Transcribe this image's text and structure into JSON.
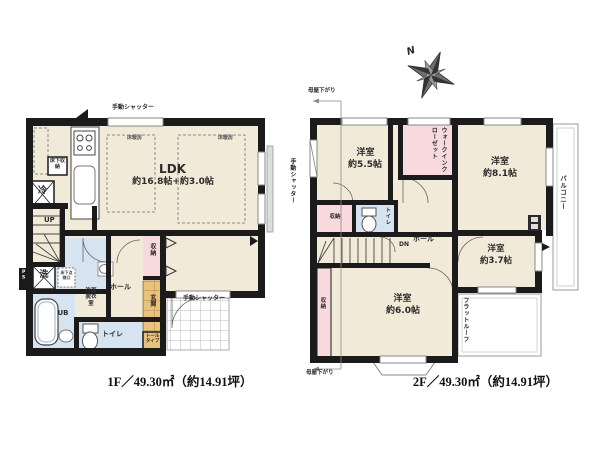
{
  "palette": {
    "wall": "#1b1b1b",
    "room_cream": "#f1ead8",
    "closet_pink": "#f8d9de",
    "wet_blue": "#d6e4f1",
    "tile_orange": "#e9c27e",
    "outline_gray": "#999999"
  },
  "compass": {
    "north_label": "N"
  },
  "floor1": {
    "caption": "1F／49.30㎡（約14.91坪）",
    "rooms": {
      "ldk_name": "LDK",
      "ldk_size": "約16.8帖+約3.0帖",
      "washroom": "洗面脱衣室",
      "bath": "UB",
      "toilet": "トイレ",
      "hall": "ホール",
      "closet": "収納",
      "entrance": "玄関"
    },
    "labels": {
      "shutter_top": "手動シャッター",
      "shutter_right": "手動シャッター",
      "shutter_bottom": "手動シャッター",
      "floor_heating": "床暖房",
      "underfloor_storage": "床下収納",
      "underfloor_hatch": "床下点検口",
      "fridge": "冷",
      "washer": "洗",
      "stairs_up": "UP",
      "tall_cabinet": "トールタイプ",
      "pipe_space": "PS"
    }
  },
  "floor2": {
    "caption": "2F／49.30㎡（約14.91坪）",
    "rooms": {
      "room55_name": "洋室",
      "room55_size": "約5.5帖",
      "room81_name": "洋室",
      "room81_size": "約8.1帖",
      "room37_name": "洋室",
      "room37_size": "約3.7帖",
      "room60_name": "洋室",
      "room60_size": "約6.0帖",
      "wic": "ウォークインクローゼット",
      "toilet": "トイレ",
      "hall": "ホール",
      "closet_top": "収納",
      "closet_left": "収納"
    },
    "labels": {
      "balcony": "バルコニー",
      "flat_roof": "フラットルーフ",
      "stairs_down": "DN",
      "moya_top": "母屋下がり",
      "moya_bottom": "母屋下がり"
    }
  }
}
